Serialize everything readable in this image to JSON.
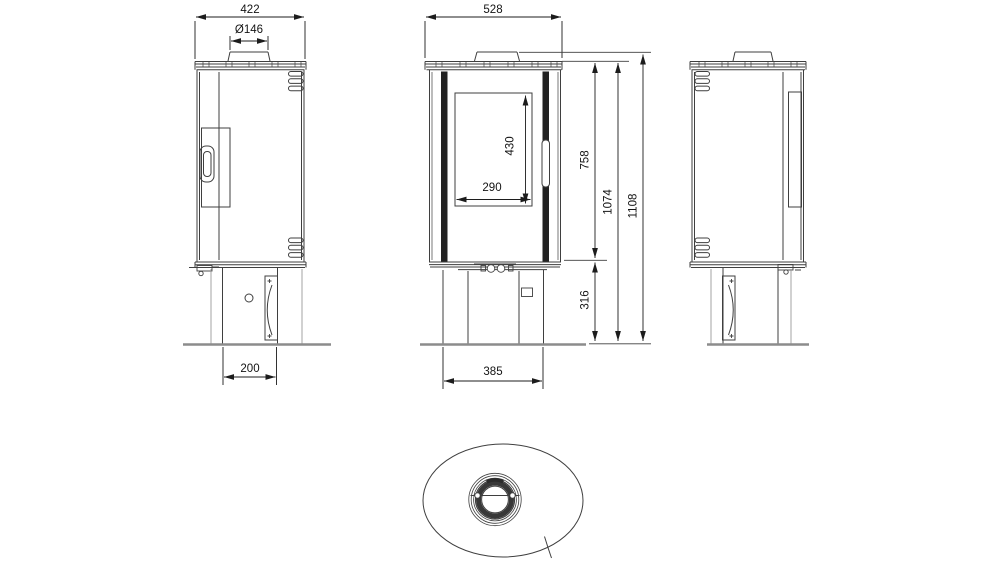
{
  "drawing_title": "Stove technical drawing - three orthographic views and top view",
  "colors": {
    "line": "#3f3f3f",
    "dimension": "#1c1c1c",
    "floor": "#8c8c8c",
    "aux": "#9a9a9a",
    "dark_fill": "#222222",
    "background": "#ffffff"
  },
  "dimensions": {
    "top_depth": "422",
    "flue_diameter": "Ø146",
    "top_width": "528",
    "glass_height": "430",
    "glass_width": "290",
    "body_height": "758",
    "height_to_top_plate": "1074",
    "total_height": "1108",
    "base_height": "316",
    "base_depth": "200",
    "base_width": "385"
  }
}
